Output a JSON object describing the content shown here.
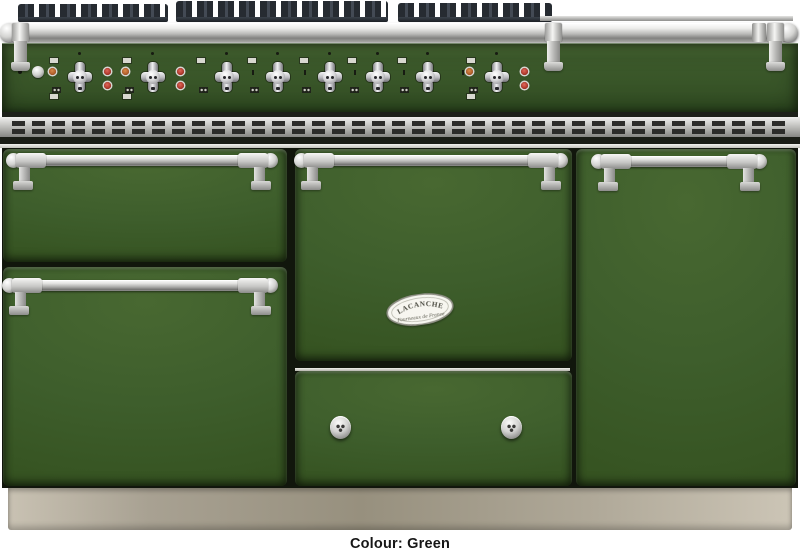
{
  "type": "product-photo",
  "subject": "front view of a green range cooker",
  "caption": {
    "text": "Colour: Green"
  },
  "product": {
    "brand": "LACANCHE",
    "badge_tagline": "Fourneaux de France",
    "colour_name": "Green"
  },
  "colors": {
    "body_green": "#3e5e2c",
    "body_green_dark": "#34511f",
    "panel_green": "#3c5a2b",
    "chrome_light": "#f5f5f3",
    "chrome_dark": "#828280",
    "grate_dark": "#262b31",
    "indicator_red": "#a52e22",
    "indicator_orange": "#a85423",
    "plinth_beige": "#b0a999",
    "gap_dark": "#11160c",
    "background": "#ffffff",
    "caption_text": "#161616"
  },
  "cooktop": {
    "grate_sections": 3
  },
  "control_panel": {
    "burner_knobs": [
      {
        "x": 80,
        "pilot": true
      },
      {
        "x": 153,
        "pilot": true
      },
      {
        "x": 227
      },
      {
        "x": 278
      },
      {
        "x": 330
      },
      {
        "x": 378
      },
      {
        "x": 428
      },
      {
        "x": 497,
        "pilot": true
      }
    ],
    "ticks": [
      252,
      304,
      354,
      403,
      462
    ],
    "ignition_button": true
  },
  "rail_brackets": [
    14,
    547,
    769
  ],
  "doors": {
    "left_top": "storage drawer",
    "left_bottom": "oven door",
    "middle_top": "main oven door with badge",
    "middle_bottom": "warming drawer with two knobs",
    "right": "tall oven door"
  }
}
